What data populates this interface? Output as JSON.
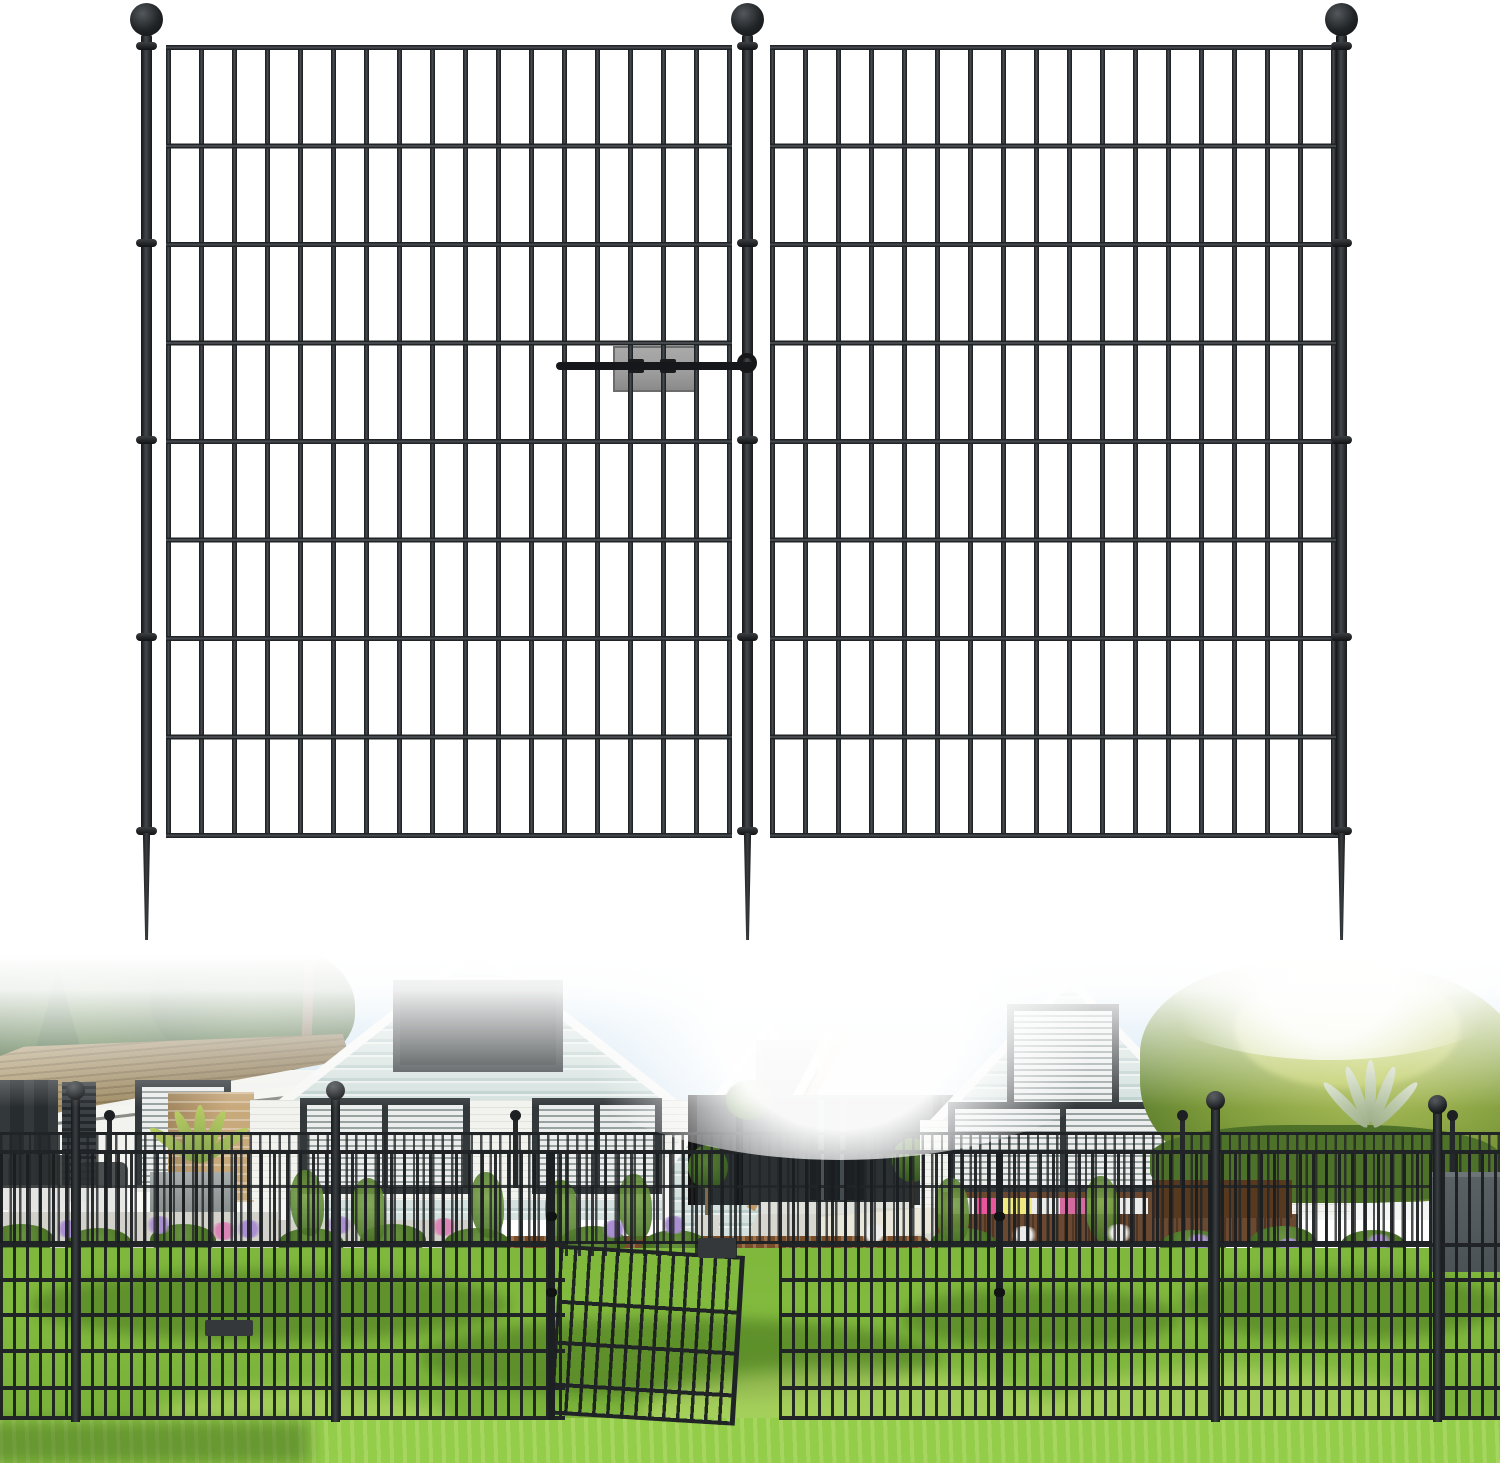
{
  "image": {
    "kind": "product-photo",
    "subject": "black metal no-dig garden fence panels with ball-top posts and ground stakes",
    "visible_text": ""
  },
  "product_render": {
    "panels": 2,
    "horizontal_rails_per_panel": 9,
    "vertical_pickets_per_panel": 18,
    "posts_with_ball_finials": 3,
    "ground_stakes": 3,
    "connector_clips": 1
  },
  "installation_photo": {
    "fence_rows": 2,
    "ball_top_posts_visible": 4,
    "open_gate_panel": true,
    "house_gables": 3,
    "patio_furniture": true
  },
  "palette": {
    "fence": "#212426",
    "fence_hi": "#45494d",
    "ball_dark": "#0e1012",
    "plate": "#9c9c9c",
    "plate_border": "#6c6c6c",
    "pin": "#15171a",
    "sky": "#cfe4f3",
    "sky_pale": "#eef5fa",
    "tree_dark": "#34552a",
    "tree_mid": "#4d7437",
    "hedge": "#7d9a3a",
    "hedge_light": "#bcca67",
    "hedge_dark": "#4e7129",
    "siding": "#d4e1de",
    "siding_dark": "#bccfcc",
    "siding_light": "#eaf0ee",
    "brick_white": "#f2f3ef",
    "brick_line": "#c5cabd",
    "roof_tan": "#af9c72",
    "roof_dark": "#85714e",
    "brick_tan": "#c8a97c",
    "window_frame": "#33383b",
    "window_glass": "#272c2e",
    "louver_light": "#eceeed",
    "louver_dark": "#98a2a1",
    "porch": "#2b3033",
    "path": "#d8d7cf",
    "terrace": "#d3d2ca",
    "lawn": "#82ba3e",
    "lawn_light": "#cdea7a",
    "lawn_fore": "#93cd49",
    "mulch": "#7a4d2a",
    "flower_purple": "#a98fd0",
    "flower_pink": "#d985b5",
    "flower_white": "#ececea",
    "wicker": "#6b4830",
    "wicker_dark": "#56391f",
    "cushion_pink": "#e8579b",
    "cushion_yellow": "#f0ea80",
    "planter": "#4b5256",
    "trunk": "#7b6a50",
    "white": "#ffffff"
  }
}
